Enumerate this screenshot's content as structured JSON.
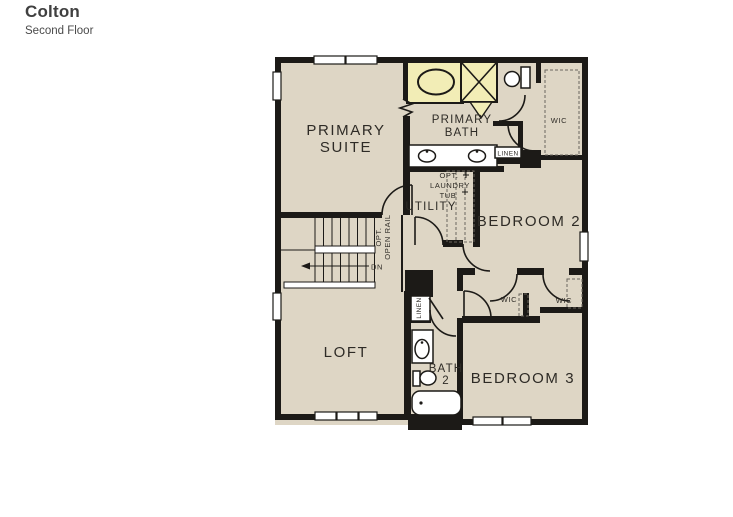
{
  "header": {
    "title": "Colton",
    "subtitle": "Second Floor"
  },
  "labels": {
    "primary_suite_line1": "PRIMARY",
    "primary_suite_line2": "SUITE",
    "primary_bath_line1": "PRIMARY",
    "primary_bath_line2": "BATH",
    "wic_primary": "WIC",
    "linen_primary": "LINEN",
    "opt_laundry_line1": "OPT.",
    "opt_laundry_line2": "LAUNDRY",
    "opt_laundry_line3": "TUB",
    "utility": "UTILITY",
    "bedroom2": "BEDROOM 2",
    "opt_open_rail_line1": "OPT.",
    "opt_open_rail_line2": "OPEN RAIL",
    "down": "DN",
    "wic_middle_left": "WIC",
    "wic_middle_right": "WIC",
    "linen_hall": "LINEN",
    "loft": "LOFT",
    "bath2_line1": "BATH",
    "bath2_line2": "2",
    "bedroom3": "BEDROOM 3"
  },
  "fixtures": [
    "garden-tub",
    "shower",
    "toilet-primary",
    "double-vanity",
    "linen-closet-primary",
    "optional-laundry-tub",
    "walk-in-closet-primary",
    "walk-in-closet-left",
    "walk-in-closet-right",
    "stairs-down",
    "linen-closet-hall",
    "sink-vanity-bath2",
    "toilet-bath2",
    "bathtub-bath2"
  ],
  "colors": {
    "floor": "#ded6c5",
    "wall": "#1c1a17",
    "fixture_fill": "#f2edb6",
    "paper": "#ffffff",
    "text": "#2e2b26",
    "title": "#404040"
  }
}
